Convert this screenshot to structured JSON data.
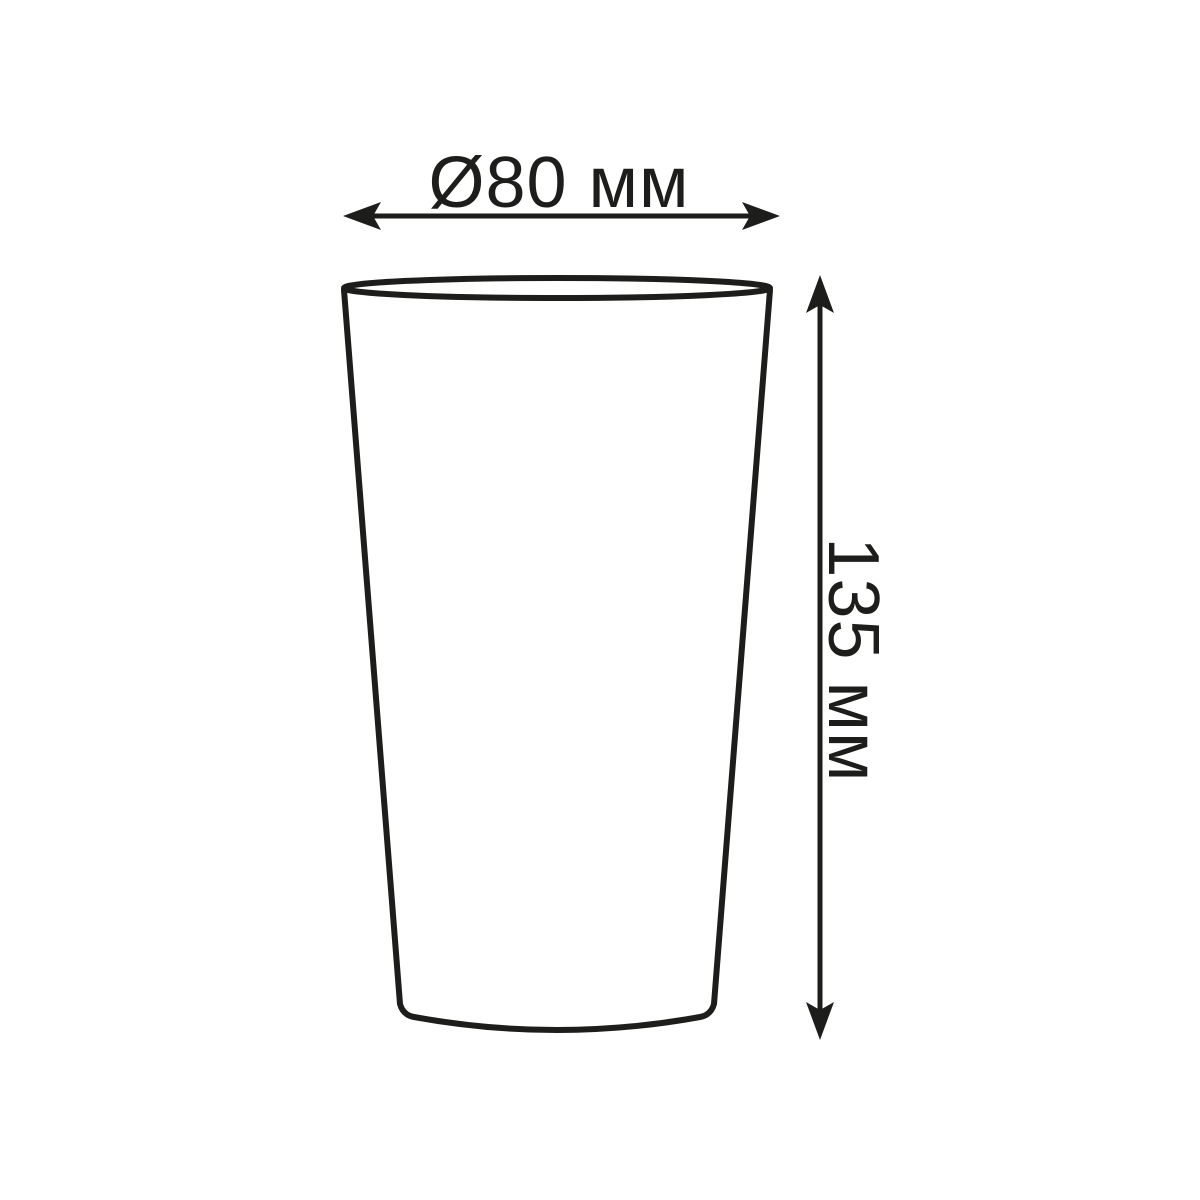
{
  "colors": {
    "line": "#1d1d1b",
    "background": "#ffffff"
  },
  "diagram": {
    "type": "technical-dimension-drawing",
    "object": "cup",
    "dimensions": {
      "diameter": {
        "label": "Ø80 мм",
        "value": 80,
        "unit": "мм",
        "orientation": "horizontal"
      },
      "height": {
        "label": "135 мм",
        "value": 135,
        "unit": "мм",
        "orientation": "vertical"
      }
    }
  }
}
